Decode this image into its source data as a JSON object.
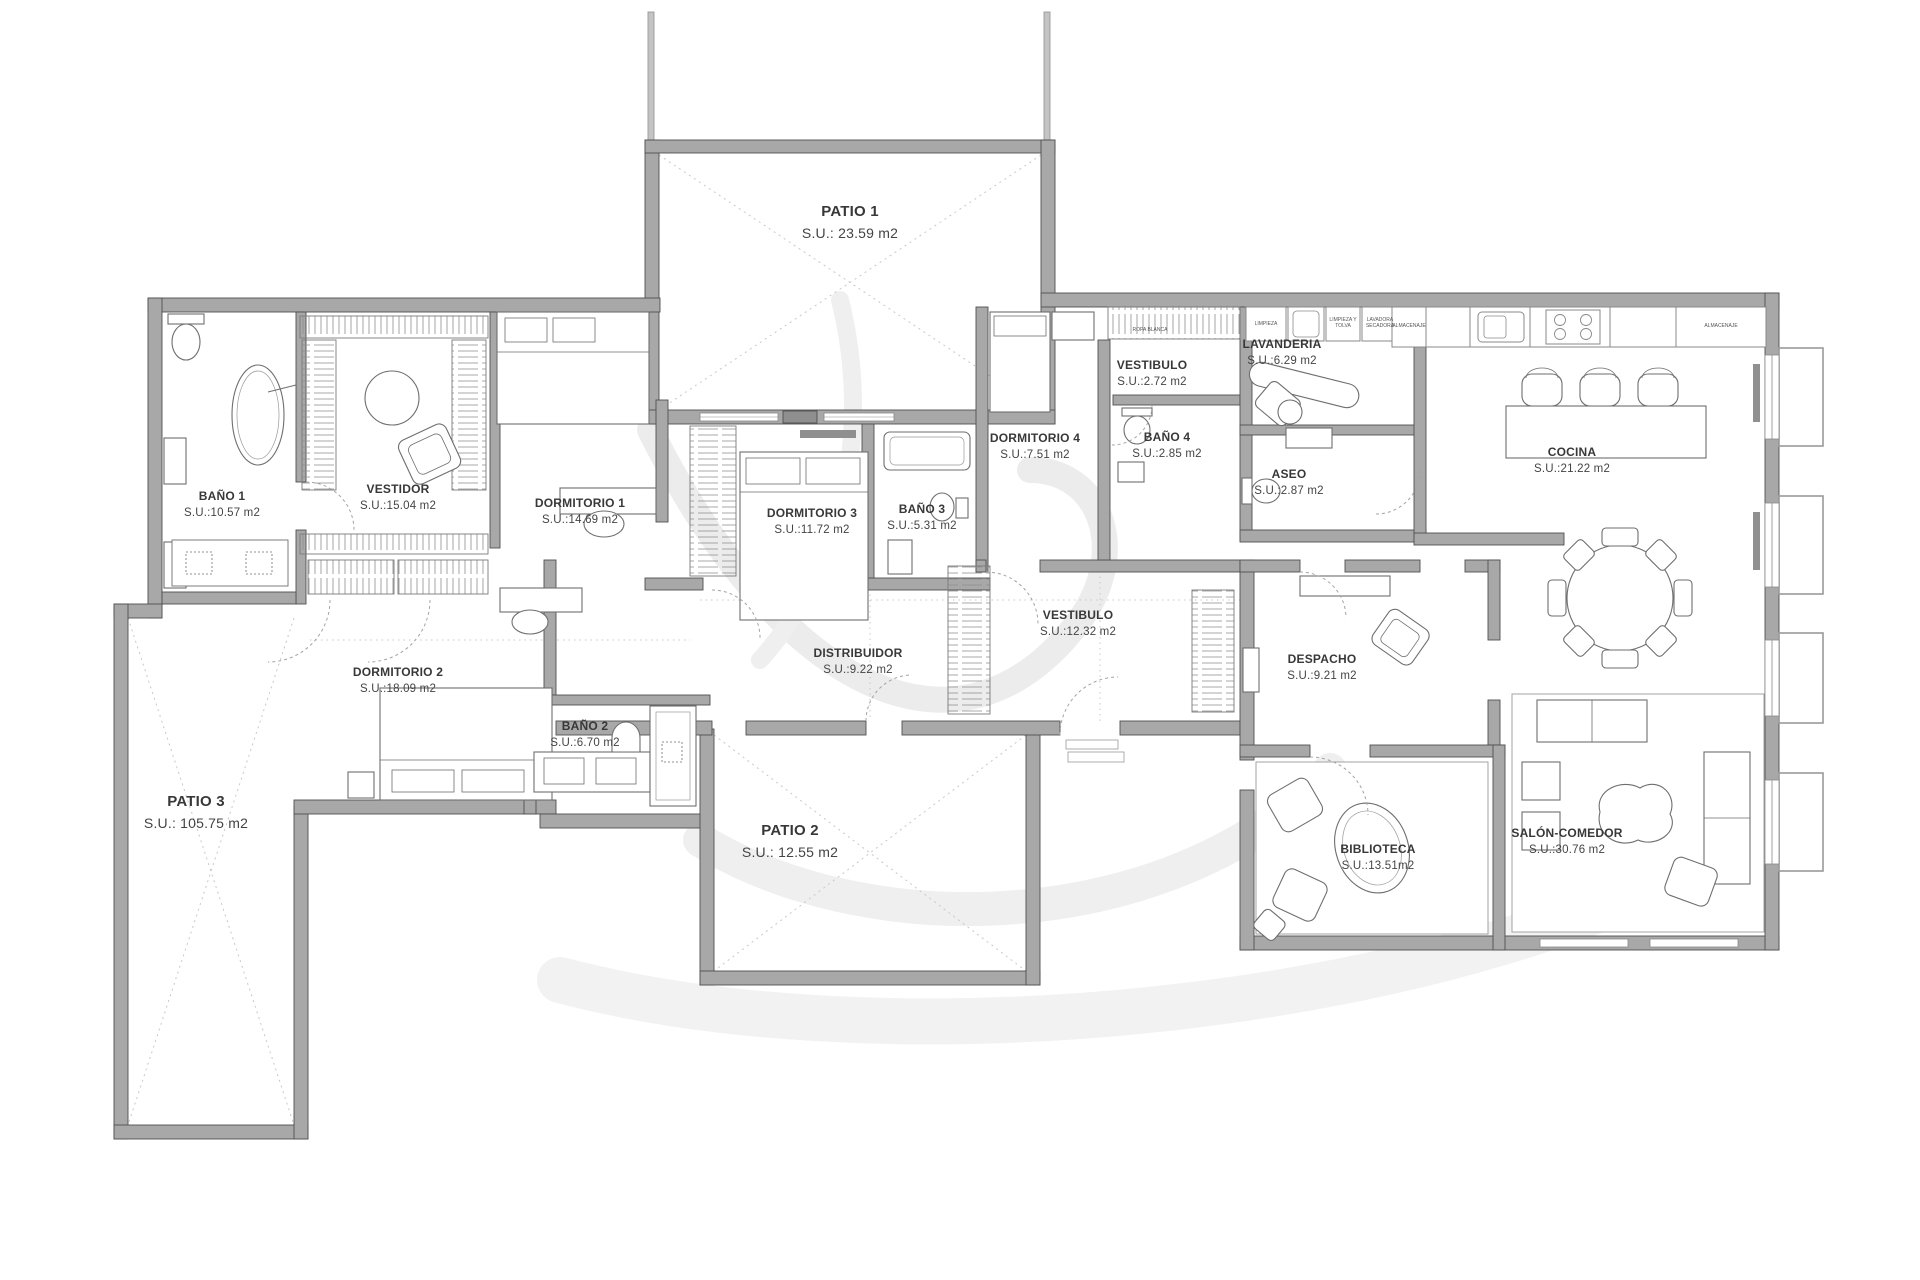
{
  "plan": {
    "title": "Apartment floor plan",
    "area_unit": "m2",
    "rooms": {
      "patio1": {
        "name": "PATIO 1",
        "area": "S.U.: 23.59 m2"
      },
      "patio2": {
        "name": "PATIO 2",
        "area": "S.U.: 12.55 m2"
      },
      "patio3": {
        "name": "PATIO 3",
        "area": "S.U.: 105.75 m2"
      },
      "bano1": {
        "name": "BAÑO 1",
        "area": "S.U.:10.57 m2"
      },
      "vestidor": {
        "name": "VESTIDOR",
        "area": "S.U.:15.04 m2"
      },
      "dormitorio1": {
        "name": "DORMITORIO 1",
        "area": "S.U.:14.69 m2"
      },
      "dormitorio2": {
        "name": "DORMITORIO 2",
        "area": "S.U.:18.09 m2"
      },
      "dormitorio3": {
        "name": "DORMITORIO 3",
        "area": "S.U.:11.72 m2"
      },
      "dormitorio4": {
        "name": "DORMITORIO 4",
        "area": "S.U.:7.51 m2"
      },
      "bano2": {
        "name": "BAÑO 2",
        "area": "S.U.:6.70 m2"
      },
      "bano3": {
        "name": "BAÑO 3",
        "area": "S.U.:5.31 m2"
      },
      "bano4": {
        "name": "BAÑO 4",
        "area": "S.U.:2.85 m2"
      },
      "vestibulo_sm": {
        "name": "VESTIBULO",
        "area": "S.U.:2.72 m2"
      },
      "vestibulo": {
        "name": "VESTIBULO",
        "area": "S.U.:12.32 m2"
      },
      "lavanderia": {
        "name": "LAVANDERIA",
        "area": "S.U.:6.29 m2"
      },
      "aseo": {
        "name": "ASEO",
        "area": "S.U.:2.87 m2"
      },
      "cocina": {
        "name": "COCINA",
        "area": "S.U.:21.22 m2"
      },
      "distribuidor": {
        "name": "DISTRIBUIDOR",
        "area": "S.U.:9.22 m2"
      },
      "despacho": {
        "name": "DESPACHO",
        "area": "S.U.:9.21 m2"
      },
      "biblioteca": {
        "name": "BIBLIOTECA",
        "area": "S.U.:13.51m2"
      },
      "salon": {
        "name": "SALÓN-COMEDOR",
        "area": "S.U.:30.76 m2"
      }
    },
    "cabinets": {
      "ropa_blanca": "ROPA BLANCA",
      "limpieza": "LIMPIEZA",
      "limpieza_tolva": "LIMPIEZA Y TOLVA",
      "lavadora_secadora": "LAVADORA SECADORA",
      "almacenaje_left": "ALMACENAJE",
      "almacenaje_right": "ALMACENAJE"
    },
    "colors": {
      "wall": "#a8a8a8",
      "wall_edge": "#505050",
      "furniture_line": "#6e6e6e",
      "dotted": "#c8c8c8",
      "label": "#3d3d3d",
      "watermark": "#e8e8e8"
    }
  }
}
